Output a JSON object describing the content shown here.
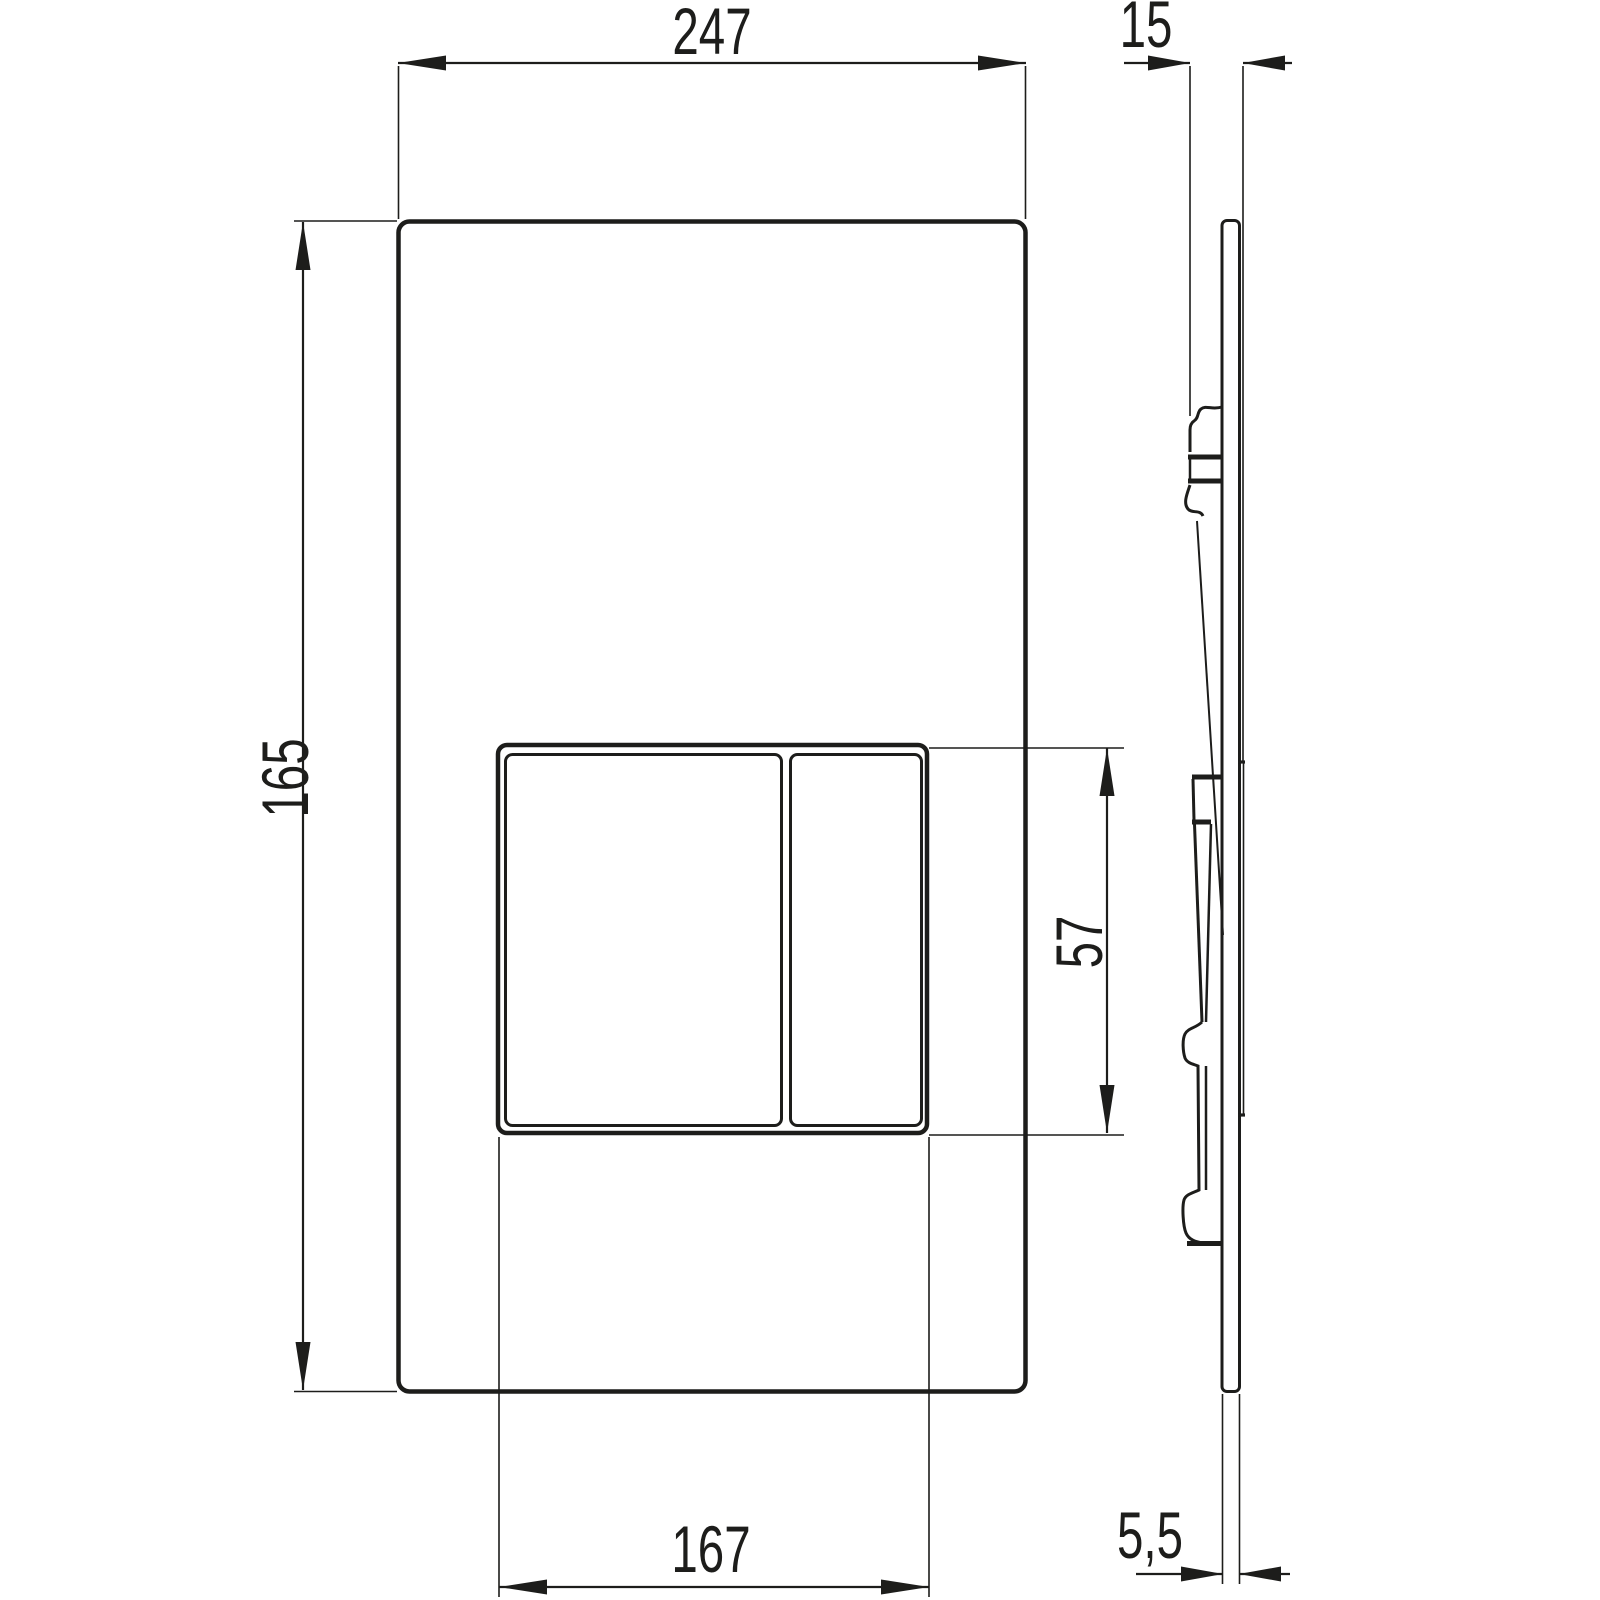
{
  "drawing": {
    "type": "technical-dimension-drawing",
    "subject": "dual-flush actuator plate, front view and side profile view",
    "line_color": "#1d1d1b",
    "background_color": "#ffffff",
    "dimensions": {
      "plate_width": "247",
      "plate_height": "165",
      "button_area_width": "167",
      "button_area_height": "57",
      "total_depth": "15",
      "plate_thickness": "5,5"
    }
  }
}
